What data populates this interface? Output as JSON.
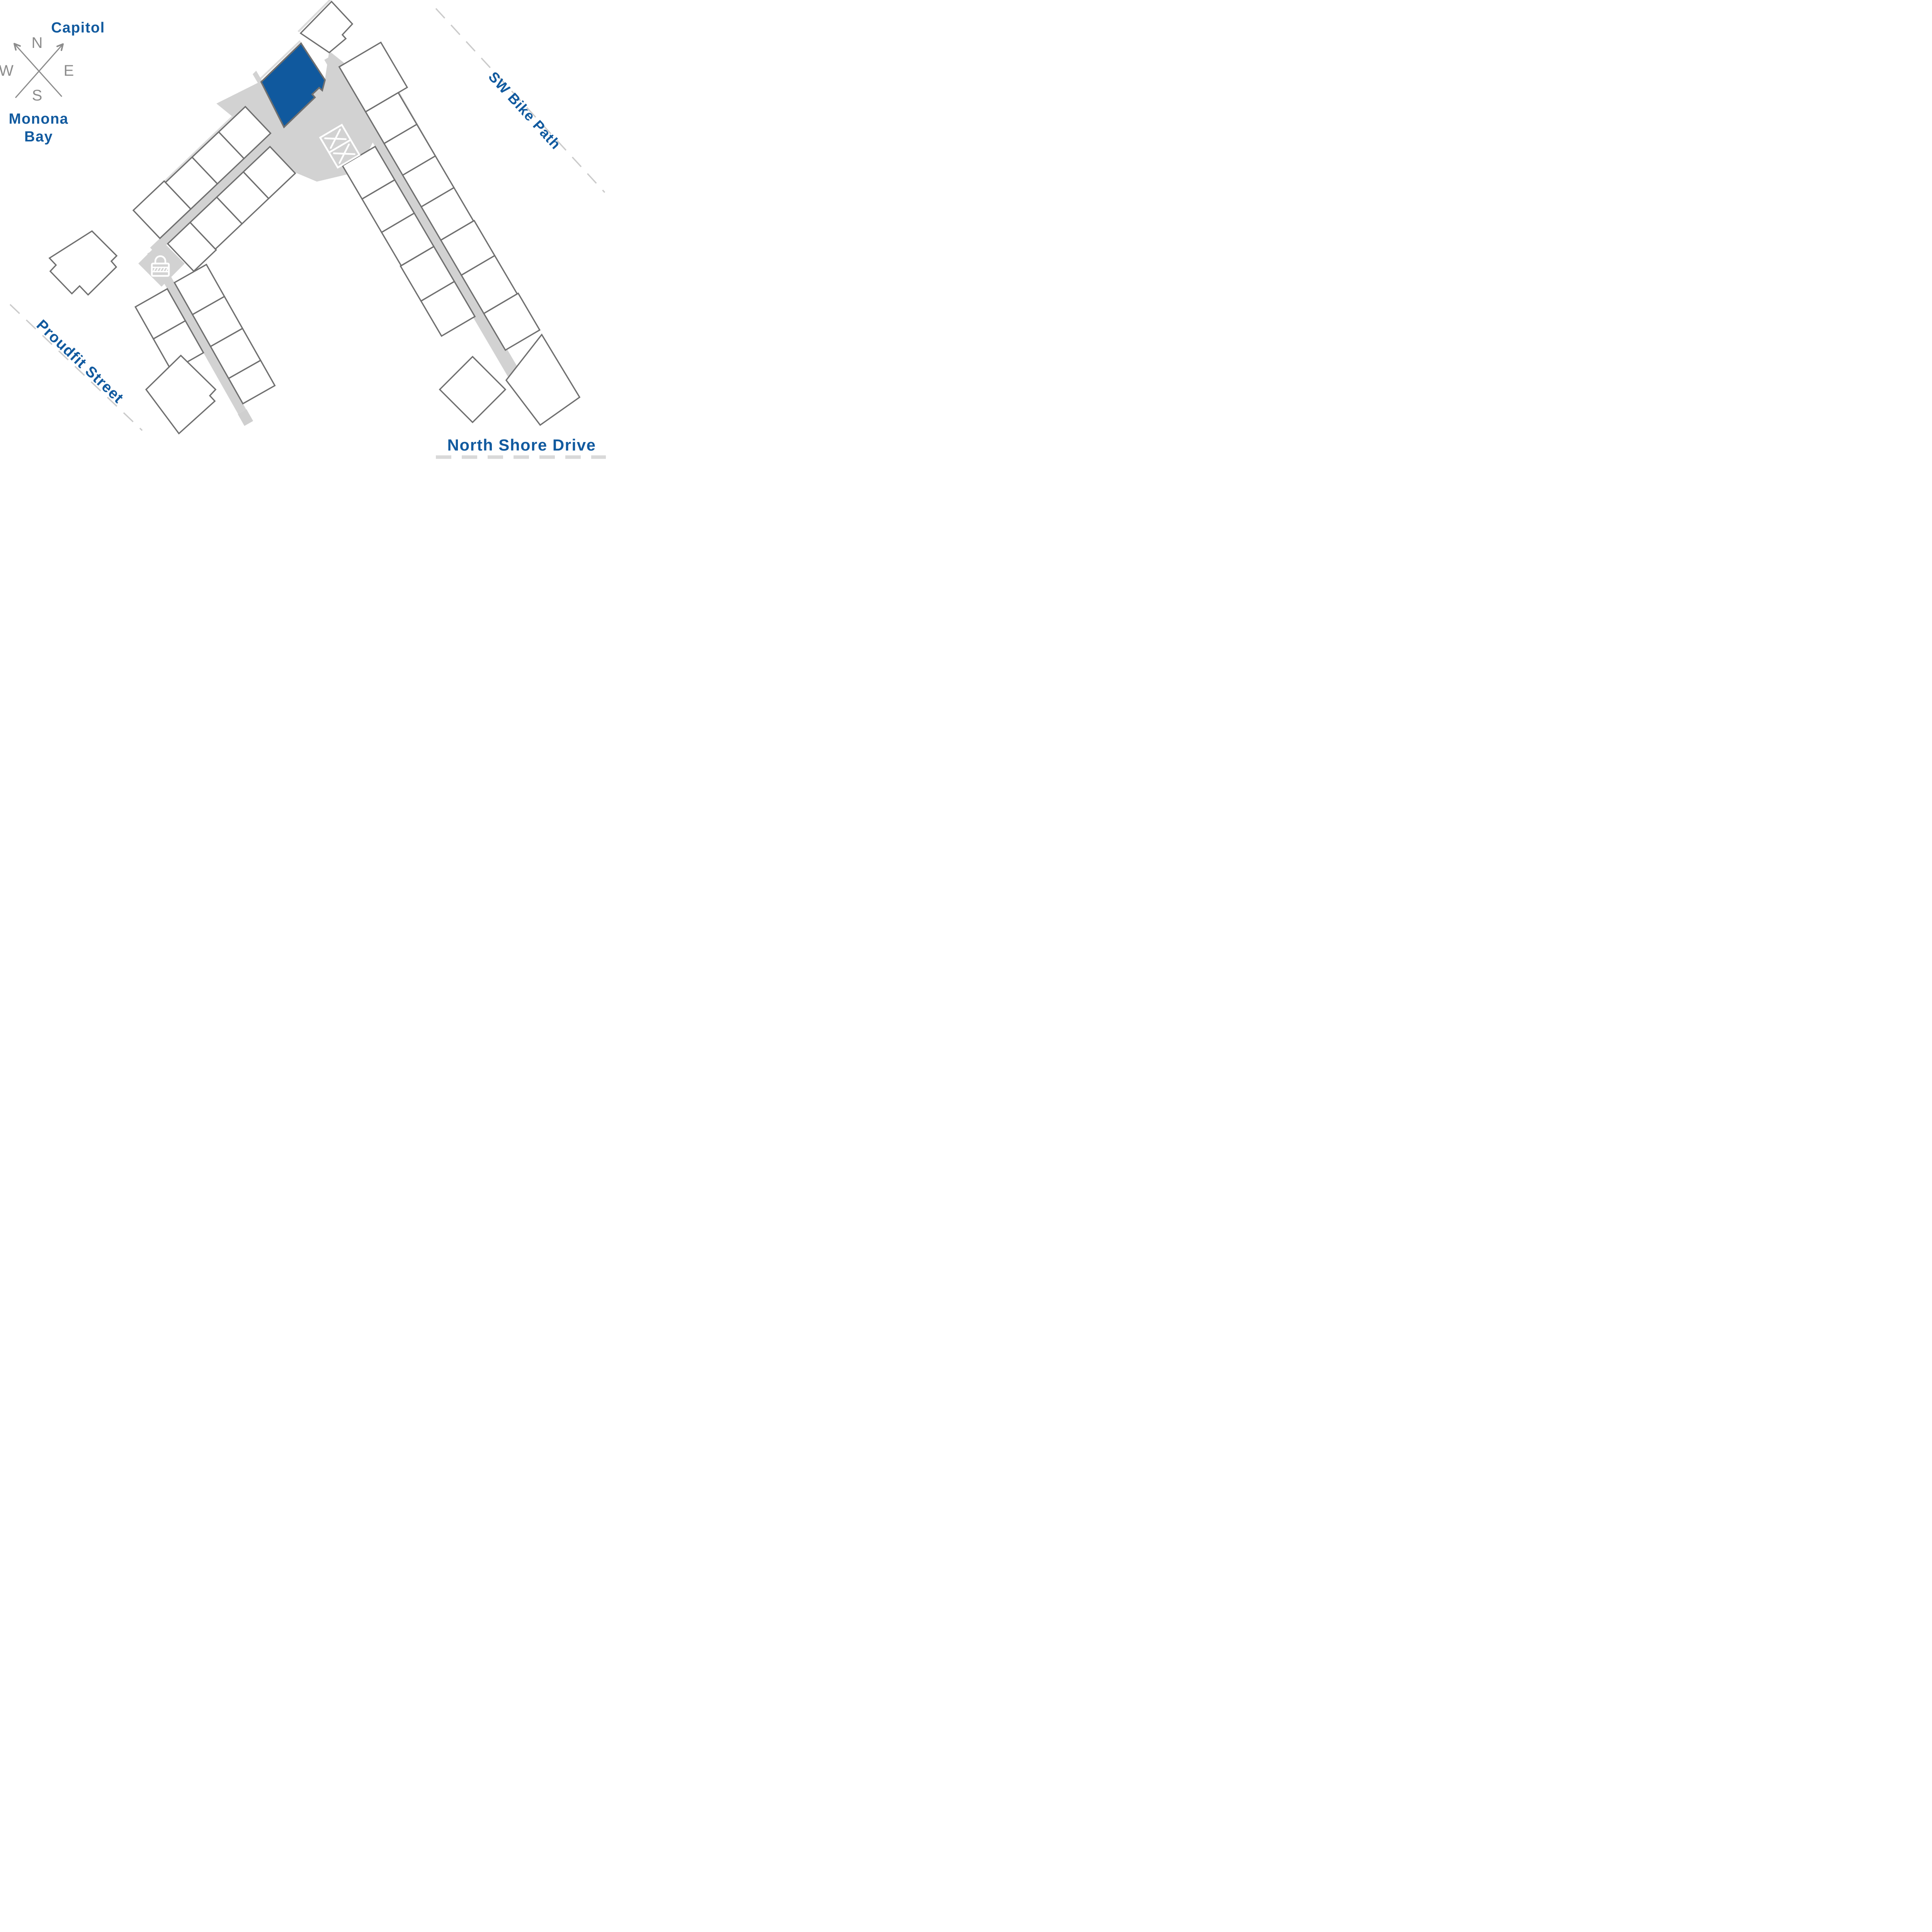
{
  "colors": {
    "brand_blue": "#115A9F",
    "highlight_fill": "#10599E",
    "corridor_gray": "#D2D2D2",
    "stub_gray": "#CFCFCF",
    "outline_gray": "#6F6F6F",
    "shadow_gray": "#DCDCDC",
    "dash_gray": "#CBCBCB",
    "dash_gray_thick": "#D9D9D9",
    "compass_gray": "#8C8C8C",
    "background": "#FFFFFF",
    "unit_fill": "#FFFFFF"
  },
  "compass": {
    "north": "N",
    "east": "E",
    "south": "S",
    "west": "W"
  },
  "labels": {
    "capitol": "Capitol",
    "monona_line1": "Monona",
    "monona_line2": "Bay",
    "sw_bike_path": "SW Bike Path",
    "proudfit_street": "Proudfit Street",
    "north_shore_drive": "North Shore Drive"
  },
  "map": {
    "highlighted_unit_state": "selected",
    "icons": {
      "lock": "lock-icon",
      "elevator": "elevator-x-icon",
      "compass": "compass-rose"
    }
  }
}
